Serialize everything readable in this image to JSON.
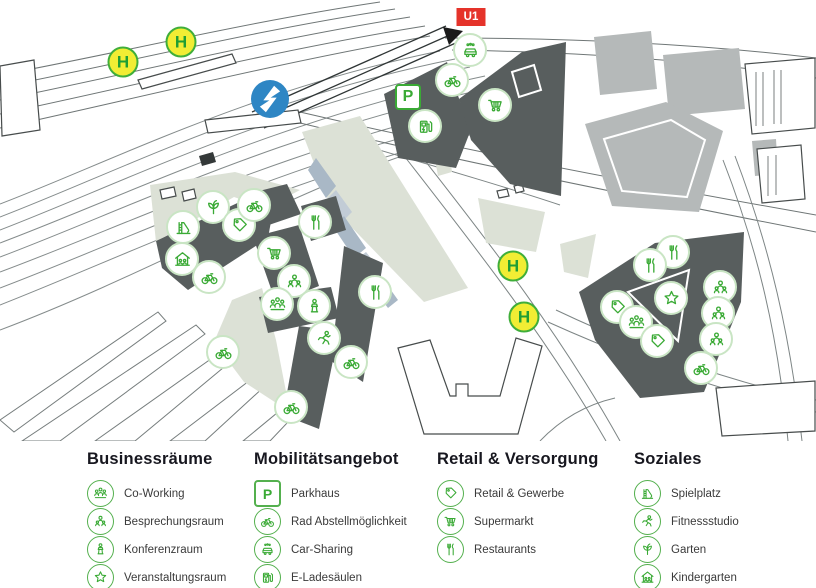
{
  "colors": {
    "accent_green": "#3aaa35",
    "marker_ring_green": "#c9e5c4",
    "h_stop_yellow": "#f1ed34",
    "u1_red": "#e5332a",
    "s_bahn_blue": "#2e86c4",
    "building_dark": "#585e5e",
    "building_medium": "#b5b9b9",
    "greenery_sage": "#dce1d6"
  },
  "labels": {
    "parking": "P",
    "tram_stop": "H",
    "u_bahn": "U1"
  },
  "map": {
    "s_badge": {
      "x": 270,
      "y": 99
    },
    "u1_badge": {
      "x": 471,
      "y": 17
    },
    "h_stops": [
      {
        "x": 123,
        "y": 62
      },
      {
        "x": 181,
        "y": 42
      },
      {
        "x": 513,
        "y": 266
      },
      {
        "x": 524,
        "y": 317
      }
    ],
    "markers": [
      {
        "icon": "car-sharing",
        "x": 470,
        "y": 50
      },
      {
        "icon": "bike-parking",
        "x": 452,
        "y": 80
      },
      {
        "icon": "parking",
        "x": 408,
        "y": 97
      },
      {
        "icon": "ev-charging",
        "x": 425,
        "y": 126
      },
      {
        "icon": "supermarket",
        "x": 495,
        "y": 105
      },
      {
        "icon": "garden",
        "x": 213,
        "y": 207
      },
      {
        "icon": "playground",
        "x": 183,
        "y": 227
      },
      {
        "icon": "retail",
        "x": 239,
        "y": 225
      },
      {
        "icon": "bike-parking",
        "x": 254,
        "y": 205
      },
      {
        "icon": "kindergarten",
        "x": 182,
        "y": 259
      },
      {
        "icon": "bike-parking",
        "x": 209,
        "y": 277
      },
      {
        "icon": "supermarket",
        "x": 274,
        "y": 253
      },
      {
        "icon": "meeting-room",
        "x": 294,
        "y": 281
      },
      {
        "icon": "co-working",
        "x": 277,
        "y": 304
      },
      {
        "icon": "conference-room",
        "x": 314,
        "y": 306
      },
      {
        "icon": "restaurant",
        "x": 315,
        "y": 222
      },
      {
        "icon": "restaurant",
        "x": 375,
        "y": 292
      },
      {
        "icon": "fitness",
        "x": 324,
        "y": 338
      },
      {
        "icon": "bike-parking",
        "x": 223,
        "y": 352
      },
      {
        "icon": "bike-parking",
        "x": 351,
        "y": 362
      },
      {
        "icon": "bike-parking",
        "x": 291,
        "y": 407
      },
      {
        "icon": "restaurant",
        "x": 673,
        "y": 252
      },
      {
        "icon": "restaurant",
        "x": 650,
        "y": 265
      },
      {
        "icon": "event-room",
        "x": 671,
        "y": 298
      },
      {
        "icon": "meeting-room",
        "x": 720,
        "y": 287
      },
      {
        "icon": "meeting-room",
        "x": 718,
        "y": 313
      },
      {
        "icon": "meeting-room",
        "x": 716,
        "y": 339
      },
      {
        "icon": "retail",
        "x": 617,
        "y": 307
      },
      {
        "icon": "co-working",
        "x": 636,
        "y": 322
      },
      {
        "icon": "retail",
        "x": 657,
        "y": 341
      },
      {
        "icon": "bike-parking",
        "x": 701,
        "y": 368
      }
    ]
  },
  "legend": {
    "sections": [
      {
        "title": "Businessräume",
        "items": [
          {
            "icon": "co-working",
            "label": "Co-Working"
          },
          {
            "icon": "meeting-room",
            "label": "Besprechungsraum"
          },
          {
            "icon": "conference-room",
            "label": "Konferenzraum"
          },
          {
            "icon": "event-room",
            "label": "Veranstaltungsraum"
          }
        ]
      },
      {
        "title": "Mobilitätsangebot",
        "items": [
          {
            "icon": "parking",
            "label": "Parkhaus"
          },
          {
            "icon": "bike-parking",
            "label": "Rad Abstellmöglichkeit"
          },
          {
            "icon": "car-sharing",
            "label": "Car-Sharing"
          },
          {
            "icon": "ev-charging",
            "label": "E-Ladesäulen"
          }
        ]
      },
      {
        "title": "Retail & Versorgung",
        "items": [
          {
            "icon": "retail",
            "label": "Retail & Gewerbe"
          },
          {
            "icon": "supermarket",
            "label": "Supermarkt"
          },
          {
            "icon": "restaurant",
            "label": "Restaurants"
          }
        ]
      },
      {
        "title": "Soziales",
        "items": [
          {
            "icon": "playground",
            "label": "Spielplatz"
          },
          {
            "icon": "fitness",
            "label": "Fitnessstudio"
          },
          {
            "icon": "garden",
            "label": "Garten"
          },
          {
            "icon": "kindergarten",
            "label": "Kindergarten"
          }
        ]
      }
    ]
  }
}
